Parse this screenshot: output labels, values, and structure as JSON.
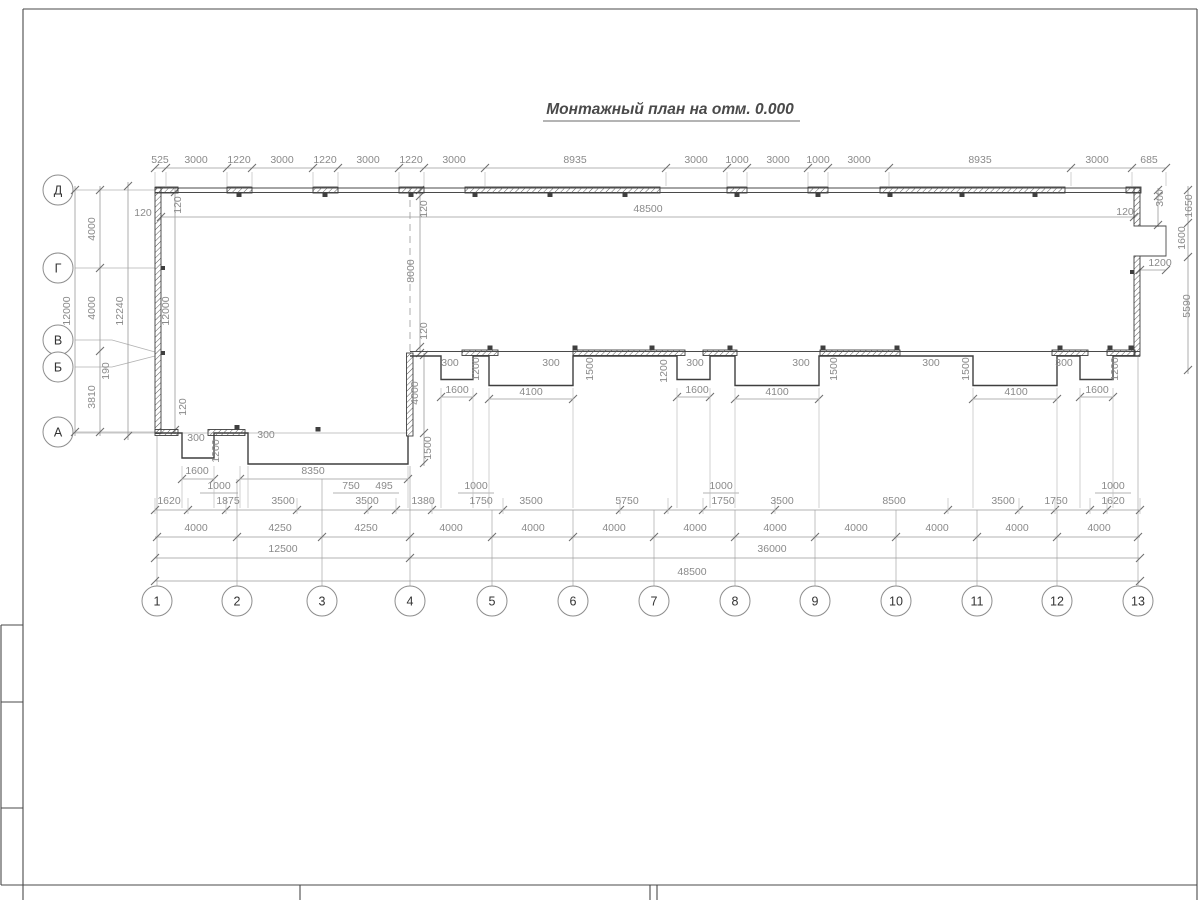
{
  "title": "Монтажный план на отм. 0.000",
  "colors": {
    "wall": "#3f3f3f",
    "dimension_line": "#9a9a9a",
    "dimension_text": "#8a8a8a",
    "axis_line": "#b3b3b3",
    "bubble_stroke": "#8d8d8d",
    "title_text": "#4a4a4a",
    "background": "#ffffff"
  },
  "axes": {
    "rows": [
      "Д",
      "Г",
      "В",
      "Б",
      "А"
    ],
    "cols": [
      "1",
      "2",
      "3",
      "4",
      "5",
      "6",
      "7",
      "8",
      "9",
      "10",
      "11",
      "12",
      "13"
    ]
  },
  "labels": [
    {
      "g": "top",
      "t": "525",
      "x": 160,
      "y": 163,
      "o": "h"
    },
    {
      "g": "top",
      "t": "3000",
      "x": 196,
      "y": 163,
      "o": "h"
    },
    {
      "g": "top",
      "t": "1220",
      "x": 239,
      "y": 163,
      "o": "h"
    },
    {
      "g": "top",
      "t": "3000",
      "x": 282,
      "y": 163,
      "o": "h"
    },
    {
      "g": "top",
      "t": "1220",
      "x": 325,
      "y": 163,
      "o": "h"
    },
    {
      "g": "top",
      "t": "3000",
      "x": 368,
      "y": 163,
      "o": "h"
    },
    {
      "g": "top",
      "t": "1220",
      "x": 411,
      "y": 163,
      "o": "h"
    },
    {
      "g": "top",
      "t": "3000",
      "x": 454,
      "y": 163,
      "o": "h"
    },
    {
      "g": "top",
      "t": "8935",
      "x": 575,
      "y": 163,
      "o": "h"
    },
    {
      "g": "top",
      "t": "3000",
      "x": 696,
      "y": 163,
      "o": "h"
    },
    {
      "g": "top",
      "t": "1000",
      "x": 737,
      "y": 163,
      "o": "h"
    },
    {
      "g": "top",
      "t": "3000",
      "x": 778,
      "y": 163,
      "o": "h"
    },
    {
      "g": "top",
      "t": "1000",
      "x": 818,
      "y": 163,
      "o": "h"
    },
    {
      "g": "top",
      "t": "3000",
      "x": 859,
      "y": 163,
      "o": "h"
    },
    {
      "g": "top",
      "t": "8935",
      "x": 980,
      "y": 163,
      "o": "h"
    },
    {
      "g": "top",
      "t": "3000",
      "x": 1097,
      "y": 163,
      "o": "h"
    },
    {
      "g": "top",
      "t": "685",
      "x": 1149,
      "y": 163,
      "o": "h"
    },
    {
      "g": "inner",
      "t": "48500",
      "x": 648,
      "y": 212,
      "o": "h"
    },
    {
      "g": "left",
      "t": "120",
      "x": 143,
      "y": 216,
      "o": "h"
    },
    {
      "g": "left",
      "t": "120",
      "x": 181,
      "y": 205,
      "o": "v"
    },
    {
      "g": "left",
      "t": "4000",
      "x": 95,
      "y": 229,
      "o": "v"
    },
    {
      "g": "left",
      "t": "4000",
      "x": 95,
      "y": 308,
      "o": "v"
    },
    {
      "g": "left",
      "t": "12000",
      "x": 70,
      "y": 311,
      "o": "v"
    },
    {
      "g": "left",
      "t": "12240",
      "x": 123,
      "y": 311,
      "o": "v"
    },
    {
      "g": "left",
      "t": "12000",
      "x": 169,
      "y": 311,
      "o": "v"
    },
    {
      "g": "left",
      "t": "190",
      "x": 109,
      "y": 371,
      "o": "v"
    },
    {
      "g": "left",
      "t": "3810",
      "x": 95,
      "y": 397,
      "o": "v"
    },
    {
      "g": "left",
      "t": "120",
      "x": 186,
      "y": 407,
      "o": "v"
    },
    {
      "g": "right",
      "t": "300",
      "x": 1163,
      "y": 198,
      "o": "v"
    },
    {
      "g": "right",
      "t": "1650",
      "x": 1192,
      "y": 206,
      "o": "v"
    },
    {
      "g": "right",
      "t": "120",
      "x": 1125,
      "y": 215,
      "o": "h"
    },
    {
      "g": "right",
      "t": "1600",
      "x": 1185,
      "y": 238,
      "o": "v"
    },
    {
      "g": "right",
      "t": "1200",
      "x": 1160,
      "y": 266,
      "o": "h"
    },
    {
      "g": "right",
      "t": "5590",
      "x": 1190,
      "y": 306,
      "o": "v"
    },
    {
      "g": "grid4",
      "t": "120",
      "x": 427,
      "y": 209,
      "o": "v"
    },
    {
      "g": "grid4",
      "t": "8000",
      "x": 414,
      "y": 271,
      "o": "v"
    },
    {
      "g": "grid4",
      "t": "120",
      "x": 427,
      "y": 331,
      "o": "v"
    },
    {
      "g": "grid4",
      "t": "4000",
      "x": 418,
      "y": 393,
      "o": "v"
    },
    {
      "g": "grid4",
      "t": "1500",
      "x": 431,
      "y": 448,
      "o": "v"
    },
    {
      "g": "row-a",
      "t": "300",
      "x": 196,
      "y": 441,
      "o": "h"
    },
    {
      "g": "row-a",
      "t": "1200",
      "x": 219,
      "y": 451,
      "o": "v"
    },
    {
      "g": "row-a",
      "t": "300",
      "x": 266,
      "y": 438,
      "o": "h"
    },
    {
      "g": "row-a",
      "t": "1600",
      "x": 197,
      "y": 474,
      "o": "h"
    },
    {
      "g": "row-a",
      "t": "8350",
      "x": 313,
      "y": 474,
      "o": "h"
    },
    {
      "g": "row-b",
      "t": "300",
      "x": 450,
      "y": 366,
      "o": "h"
    },
    {
      "g": "row-b",
      "t": "1200",
      "x": 479,
      "y": 369,
      "o": "v"
    },
    {
      "g": "row-b",
      "t": "1600",
      "x": 457,
      "y": 393,
      "o": "h"
    },
    {
      "g": "row-b",
      "t": "300",
      "x": 551,
      "y": 366,
      "o": "h"
    },
    {
      "g": "row-b",
      "t": "1500",
      "x": 593,
      "y": 369,
      "o": "v"
    },
    {
      "g": "row-b",
      "t": "4100",
      "x": 531,
      "y": 395,
      "o": "h"
    },
    {
      "g": "row-b",
      "t": "1200",
      "x": 667,
      "y": 371,
      "o": "v"
    },
    {
      "g": "row-b",
      "t": "300",
      "x": 695,
      "y": 366,
      "o": "h"
    },
    {
      "g": "row-b",
      "t": "1600",
      "x": 697,
      "y": 393,
      "o": "h"
    },
    {
      "g": "row-b",
      "t": "300",
      "x": 801,
      "y": 366,
      "o": "h"
    },
    {
      "g": "row-b",
      "t": "1500",
      "x": 837,
      "y": 369,
      "o": "v"
    },
    {
      "g": "row-b",
      "t": "4100",
      "x": 777,
      "y": 395,
      "o": "h"
    },
    {
      "g": "row-b",
      "t": "300",
      "x": 931,
      "y": 366,
      "o": "h"
    },
    {
      "g": "row-b",
      "t": "1500",
      "x": 969,
      "y": 369,
      "o": "v"
    },
    {
      "g": "row-b",
      "t": "4100",
      "x": 1016,
      "y": 395,
      "o": "h"
    },
    {
      "g": "row-b",
      "t": "300",
      "x": 1064,
      "y": 366,
      "o": "h"
    },
    {
      "g": "row-b",
      "t": "1200",
      "x": 1118,
      "y": 369,
      "o": "v"
    },
    {
      "g": "row-b",
      "t": "1600",
      "x": 1097,
      "y": 393,
      "o": "h"
    },
    {
      "g": "chain1",
      "t": "1620",
      "x": 169,
      "y": 504,
      "o": "h"
    },
    {
      "g": "chain1",
      "t": "1875",
      "x": 228,
      "y": 504,
      "o": "h"
    },
    {
      "g": "chain1",
      "t": "3500",
      "x": 283,
      "y": 504,
      "o": "h"
    },
    {
      "g": "chain1",
      "t": "3500",
      "x": 367,
      "y": 504,
      "o": "h"
    },
    {
      "g": "chain1",
      "t": "1380",
      "x": 423,
      "y": 504,
      "o": "h"
    },
    {
      "g": "chain1",
      "t": "1750",
      "x": 481,
      "y": 504,
      "o": "h"
    },
    {
      "g": "chain1",
      "t": "3500",
      "x": 531,
      "y": 504,
      "o": "h"
    },
    {
      "g": "chain1",
      "t": "5750",
      "x": 627,
      "y": 504,
      "o": "h"
    },
    {
      "g": "chain1",
      "t": "1750",
      "x": 723,
      "y": 504,
      "o": "h"
    },
    {
      "g": "chain1",
      "t": "3500",
      "x": 782,
      "y": 504,
      "o": "h"
    },
    {
      "g": "chain1",
      "t": "8500",
      "x": 894,
      "y": 504,
      "o": "h"
    },
    {
      "g": "chain1",
      "t": "3500",
      "x": 1003,
      "y": 504,
      "o": "h"
    },
    {
      "g": "chain1",
      "t": "1750",
      "x": 1056,
      "y": 504,
      "o": "h"
    },
    {
      "g": "chain1",
      "t": "1620",
      "x": 1113,
      "y": 504,
      "o": "h"
    },
    {
      "g": "chain1-sub",
      "t": "1000",
      "x": 219,
      "y": 489,
      "o": "h"
    },
    {
      "g": "chain1-sub",
      "t": "750",
      "x": 351,
      "y": 489,
      "o": "h"
    },
    {
      "g": "chain1-sub",
      "t": "495",
      "x": 384,
      "y": 489,
      "o": "h"
    },
    {
      "g": "chain1-sub",
      "t": "1000",
      "x": 476,
      "y": 489,
      "o": "h"
    },
    {
      "g": "chain1-sub",
      "t": "1000",
      "x": 721,
      "y": 489,
      "o": "h"
    },
    {
      "g": "chain1-sub",
      "t": "1000",
      "x": 1113,
      "y": 489,
      "o": "h"
    },
    {
      "g": "chain2",
      "t": "4000",
      "x": 196,
      "y": 531,
      "o": "h"
    },
    {
      "g": "chain2",
      "t": "4250",
      "x": 280,
      "y": 531,
      "o": "h"
    },
    {
      "g": "chain2",
      "t": "4250",
      "x": 366,
      "y": 531,
      "o": "h"
    },
    {
      "g": "chain2",
      "t": "4000",
      "x": 451,
      "y": 531,
      "o": "h"
    },
    {
      "g": "chain2",
      "t": "4000",
      "x": 533,
      "y": 531,
      "o": "h"
    },
    {
      "g": "chain2",
      "t": "4000",
      "x": 614,
      "y": 531,
      "o": "h"
    },
    {
      "g": "chain2",
      "t": "4000",
      "x": 695,
      "y": 531,
      "o": "h"
    },
    {
      "g": "chain2",
      "t": "4000",
      "x": 775,
      "y": 531,
      "o": "h"
    },
    {
      "g": "chain2",
      "t": "4000",
      "x": 856,
      "y": 531,
      "o": "h"
    },
    {
      "g": "chain2",
      "t": "4000",
      "x": 937,
      "y": 531,
      "o": "h"
    },
    {
      "g": "chain2",
      "t": "4000",
      "x": 1017,
      "y": 531,
      "o": "h"
    },
    {
      "g": "chain2",
      "t": "4000",
      "x": 1099,
      "y": 531,
      "o": "h"
    },
    {
      "g": "chain3",
      "t": "12500",
      "x": 283,
      "y": 552,
      "o": "h"
    },
    {
      "g": "chain3",
      "t": "36000",
      "x": 772,
      "y": 552,
      "o": "h"
    },
    {
      "g": "chain4",
      "t": "48500",
      "x": 692,
      "y": 575,
      "o": "h"
    }
  ]
}
